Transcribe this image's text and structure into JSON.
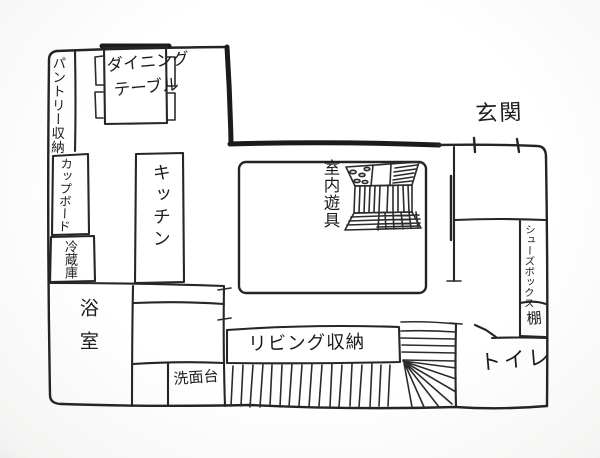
{
  "floorplan": {
    "labels": {
      "pantry": "パントリー収納",
      "dining_line1": "ダイニング",
      "dining_line2": "テーブル",
      "cupboard": "カップボード",
      "fridge": "冷蔵庫",
      "kitchen": "キッチン",
      "indoor_play": "室内遊具",
      "entrance": "玄関",
      "shoe_box": "シューズボックス",
      "shelf": "棚",
      "toilet": "トイレ",
      "living_storage": "リビング収納",
      "washstand": "洗面台",
      "bathroom": "浴室"
    },
    "colors": {
      "ink": "#262626",
      "paper": "#fbfbfb"
    }
  }
}
